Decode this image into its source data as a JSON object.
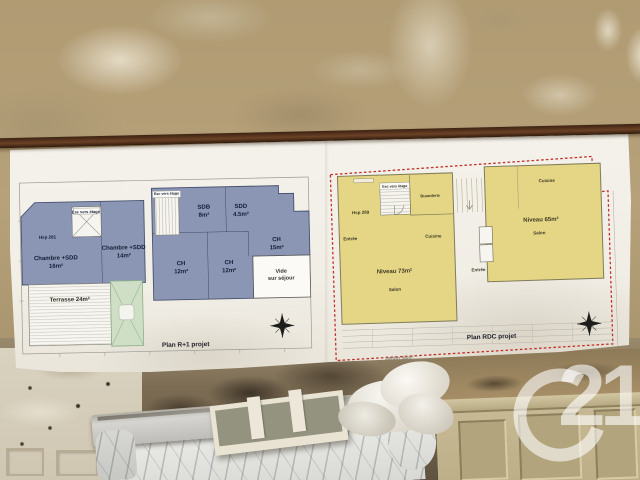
{
  "scene": {
    "description": "Photo: two project floor plans on a paper banner fixed to a distressed wall above a marble fireplace mantel, Century 21 watermark bottom right",
    "watermark": {
      "text": "21"
    }
  },
  "plans": {
    "r1": {
      "title": "Plan R+1 projet",
      "ceiling_height": "Hsp 281",
      "stair_label": "Esc vers étage",
      "rooms": {
        "chambre16": "Chambre +SDD\n16m²",
        "chambre14": "Chambre +SDD\n14m²",
        "sdb": "SDB\n8m²",
        "sdd": "SDD\n4.5m²",
        "ch15": "CH\n15m²",
        "ch12a": "CH\n12m²",
        "ch12b": "CH\n12m²",
        "vide": "Vide\nsur séjour",
        "terrasse": "Terrasse 24m²"
      }
    },
    "rdc": {
      "title": "Plan RDC projet",
      "ceiling_height": "Hsp 289",
      "stair_label": "Esc vers étage",
      "garden_label": "Jardin 58m²",
      "rooms": {
        "buanderie": "Buanderie",
        "entree_gauche": "Entrée",
        "cuisine_gauche": "Cuisine",
        "niveau_gauche": "Niveau 73m²",
        "salon_gauche": "Salon",
        "cuisine_droite": "Cuisine",
        "niveau_droit": "Niveau 65m²",
        "salon_droit": "Salon",
        "entree_droite": "Entrée"
      }
    }
  },
  "colors": {
    "plan_room_blue": "#8b96b5",
    "plan_room_yellow": "#e5d685",
    "boundary_red": "#c03028",
    "terrace_green": "#cfdfc5",
    "watermark_white": "#ffffff"
  }
}
